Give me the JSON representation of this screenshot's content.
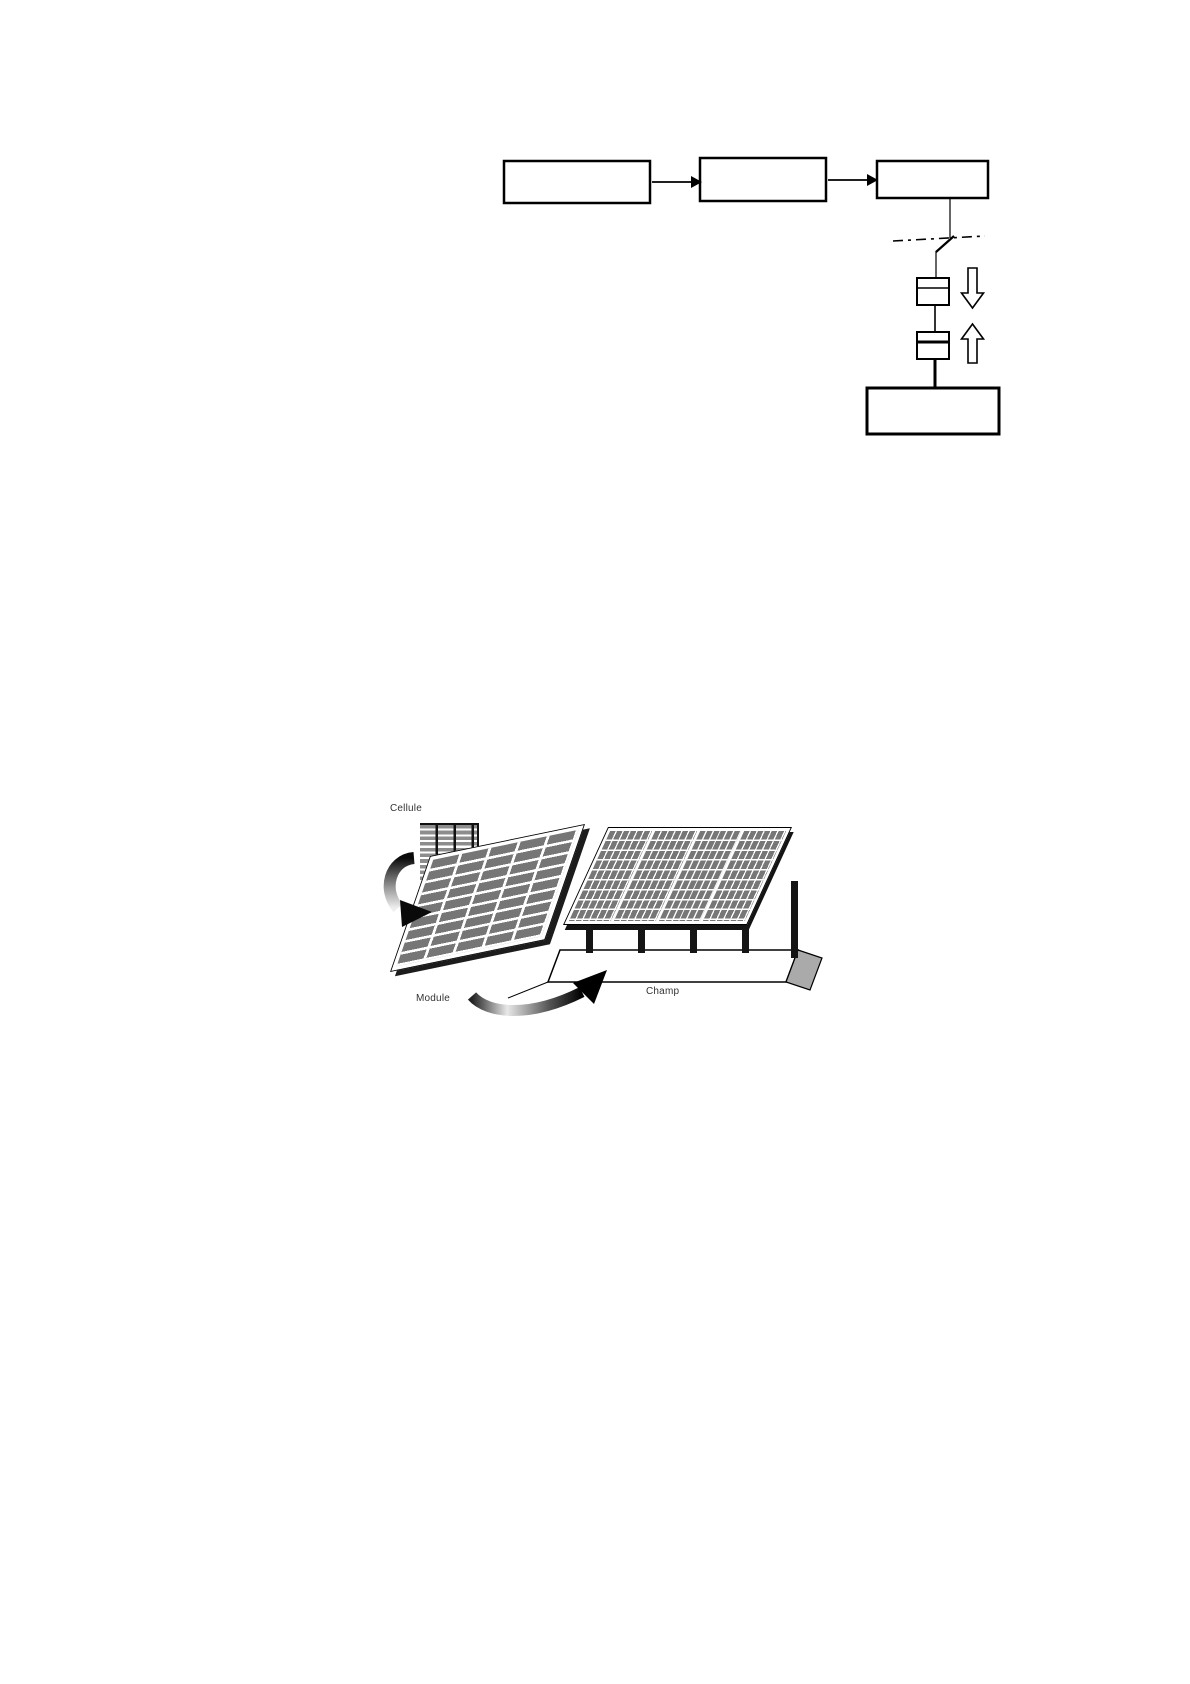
{
  "pv_figure": {
    "labels": {
      "cell": "Cellule",
      "module": "Module",
      "field": "Champ"
    },
    "structure": {
      "module_grid": {
        "columns": 5,
        "rows": 9
      },
      "field_sections": 4,
      "field_section_grid": {
        "columns": 6,
        "rows": 9
      },
      "field_posts": 4
    }
  },
  "block_diagram": {
    "flow_boxes": 3,
    "meters": 2,
    "flow_arrows": [
      "right",
      "right"
    ],
    "energy_arrows": [
      "down",
      "up"
    ],
    "switch": "disconnect-on-dash-dot-boundary"
  },
  "colors": {
    "page_bg": "#ffffff",
    "line": "#000000",
    "cell_gray": "#8d8d8d",
    "module_cell_gray": "#767676",
    "field_cell_gray": "#777777",
    "edge_dark": "#1c1c1c",
    "base_face_gray": "#aaaaaa",
    "label_text": "#333333"
  }
}
